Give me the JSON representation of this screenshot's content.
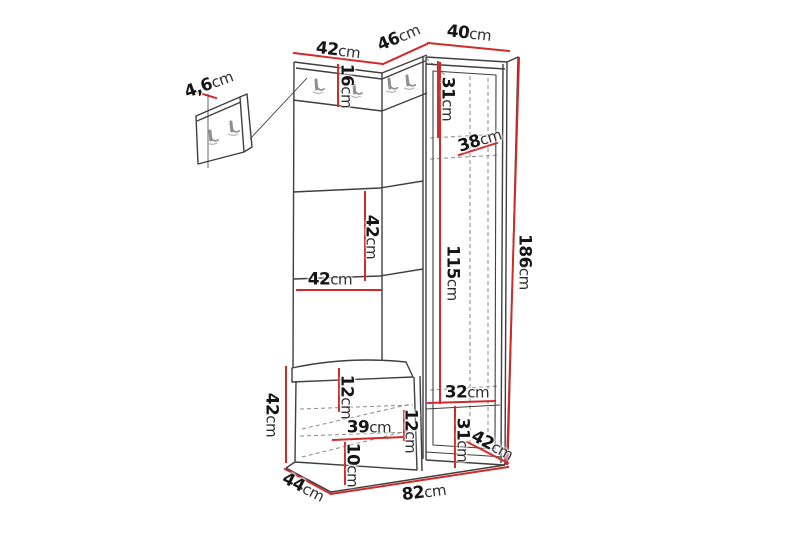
{
  "diagram": {
    "type": "furniture-dimension-drawing",
    "subject": "hallway corner wardrobe unit with coat hook panels, bench and separate wall hook panel",
    "unit": "cm",
    "colors": {
      "outline": "#3f3f3f",
      "hidden_lines": "#8a8a8a",
      "dimension": "#d02a2a",
      "text": "#151515",
      "background": "#ffffff"
    },
    "dimensions": [
      {
        "name": "top-left-section-width",
        "text": "42cm",
        "label": {
          "x": 338,
          "y": 51,
          "rotate": 7
        },
        "line": {
          "x1": 294,
          "y1": 53,
          "x2": 383,
          "y2": 64
        }
      },
      {
        "name": "top-corner-section-width",
        "text": "46cm",
        "label": {
          "x": 399,
          "y": 38,
          "rotate": -23
        },
        "line": {
          "x1": 383,
          "y1": 64,
          "x2": 427,
          "y2": 44
        }
      },
      {
        "name": "top-wardrobe-width",
        "text": "40cm",
        "label": {
          "x": 469,
          "y": 34,
          "rotate": 6
        },
        "line": {
          "x1": 428,
          "y1": 43,
          "x2": 509,
          "y2": 51
        }
      },
      {
        "name": "hook-rail-height",
        "text": "16cm",
        "label": {
          "x": 346,
          "y": 86,
          "rotate": 90
        },
        "line": {
          "x1": 338,
          "y1": 65,
          "x2": 338,
          "y2": 106
        }
      },
      {
        "name": "wall-panel-thickness",
        "text": "4,6cm",
        "label": {
          "x": 209,
          "y": 85,
          "rotate": -20
        },
        "line": {
          "x1": 196,
          "y1": 92,
          "x2": 216,
          "y2": 98
        }
      },
      {
        "name": "wardrobe-upper-shelf-height",
        "text": "31cm",
        "label": {
          "x": 447,
          "y": 99,
          "rotate": 90
        },
        "line": {
          "x1": 438,
          "y1": 62,
          "x2": 438,
          "y2": 137
        }
      },
      {
        "name": "wardrobe-upper-shelf-depth",
        "text": "38cm",
        "label": {
          "x": 480,
          "y": 141,
          "rotate": -17
        },
        "line": {
          "x1": 459,
          "y1": 155,
          "x2": 497,
          "y2": 143
        }
      },
      {
        "name": "panel-middle-section-height",
        "text": "42cm",
        "label": {
          "x": 371,
          "y": 237,
          "rotate": 90
        },
        "line": {
          "x1": 365,
          "y1": 192,
          "x2": 365,
          "y2": 280
        }
      },
      {
        "name": "panel-width",
        "text": "42cm",
        "label": {
          "x": 330,
          "y": 280,
          "rotate": 0
        },
        "line": {
          "x1": 297,
          "y1": 290,
          "x2": 381,
          "y2": 290
        }
      },
      {
        "name": "wardrobe-interior-height",
        "text": "115cm",
        "label": {
          "x": 452,
          "y": 273,
          "rotate": 90
        },
        "line": {
          "x1": 440,
          "y1": 63,
          "x2": 440,
          "y2": 403
        }
      },
      {
        "name": "total-height",
        "text": "186cm",
        "label": {
          "x": 524,
          "y": 262,
          "rotate": 90
        },
        "line": {
          "x1": 519,
          "y1": 58,
          "x2": 507,
          "y2": 464
        }
      },
      {
        "name": "bench-height",
        "text": "42cm",
        "label": {
          "x": 271,
          "y": 415,
          "rotate": 90
        },
        "line": {
          "x1": 286,
          "y1": 367,
          "x2": 286,
          "y2": 462
        }
      },
      {
        "name": "bench-top-compartment-height",
        "text": "12cm",
        "label": {
          "x": 346,
          "y": 397,
          "rotate": 90
        },
        "line": {
          "x1": 339,
          "y1": 369,
          "x2": 339,
          "y2": 411
        }
      },
      {
        "name": "bench-compartment-width",
        "text": "39cm",
        "label": {
          "x": 369,
          "y": 428,
          "rotate": 0
        },
        "line": {
          "x1": 333,
          "y1": 440,
          "x2": 403,
          "y2": 437
        }
      },
      {
        "name": "bench-side-compartment-height",
        "text": "12cm",
        "label": {
          "x": 410,
          "y": 431,
          "rotate": 90
        },
        "line": {
          "x1": 404,
          "y1": 411,
          "x2": 404,
          "y2": 440
        }
      },
      {
        "name": "bench-bottom-compartment-height",
        "text": "10cm",
        "label": {
          "x": 352,
          "y": 465,
          "rotate": 90
        },
        "line": {
          "x1": 345,
          "y1": 443,
          "x2": 345,
          "y2": 484
        }
      },
      {
        "name": "wardrobe-lower-shelf-width",
        "text": "32cm",
        "label": {
          "x": 467,
          "y": 393,
          "rotate": 0
        },
        "line": {
          "x1": 428,
          "y1": 403,
          "x2": 495,
          "y2": 401
        }
      },
      {
        "name": "wardrobe-lower-compartment-height",
        "text": "31cm",
        "label": {
          "x": 462,
          "y": 440,
          "rotate": 90
        },
        "line": {
          "x1": 455,
          "y1": 407,
          "x2": 455,
          "y2": 467
        }
      },
      {
        "name": "wardrobe-depth",
        "text": "42cm",
        "label": {
          "x": 492,
          "y": 446,
          "rotate": 28
        },
        "line": {
          "x1": 467,
          "y1": 442,
          "x2": 508,
          "y2": 463
        }
      },
      {
        "name": "bench-depth",
        "text": "44cm",
        "label": {
          "x": 303,
          "y": 488,
          "rotate": 27
        },
        "line": {
          "x1": 285,
          "y1": 469,
          "x2": 331,
          "y2": 494
        }
      },
      {
        "name": "total-width",
        "text": "82cm",
        "label": {
          "x": 424,
          "y": 493,
          "rotate": -7
        },
        "line": {
          "x1": 331,
          "y1": 494,
          "x2": 508,
          "y2": 467
        }
      }
    ]
  }
}
